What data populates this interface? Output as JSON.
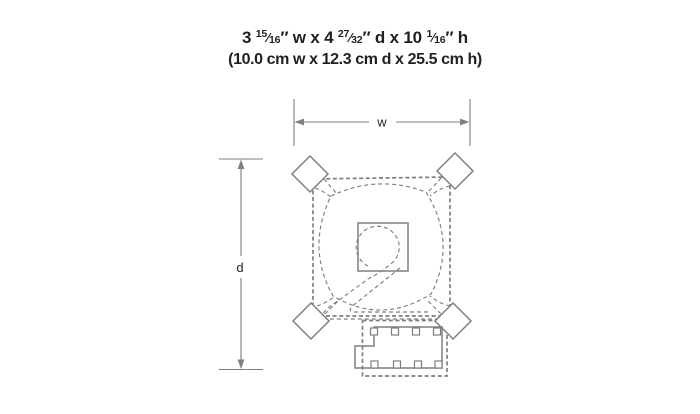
{
  "colors": {
    "line": "#7f7f7f",
    "text": "#231f20",
    "background": "#ffffff"
  },
  "title": {
    "imperial_segments": [
      {
        "t": "3 "
      },
      {
        "t": "15"
      },
      {
        "t": "⁄"
      },
      {
        "t": "16"
      },
      {
        "t": "″ w x 4 "
      },
      {
        "t": "27"
      },
      {
        "t": "⁄"
      },
      {
        "t": "32"
      },
      {
        "t": "″ d x 10 "
      },
      {
        "t": "1"
      },
      {
        "t": "⁄"
      },
      {
        "t": "16"
      },
      {
        "t": "″ h"
      }
    ],
    "metric": "(10.0 cm w x 12.3 cm d x 25.5 cm h)"
  },
  "diagram": {
    "width_label": "w",
    "depth_label": "d"
  }
}
